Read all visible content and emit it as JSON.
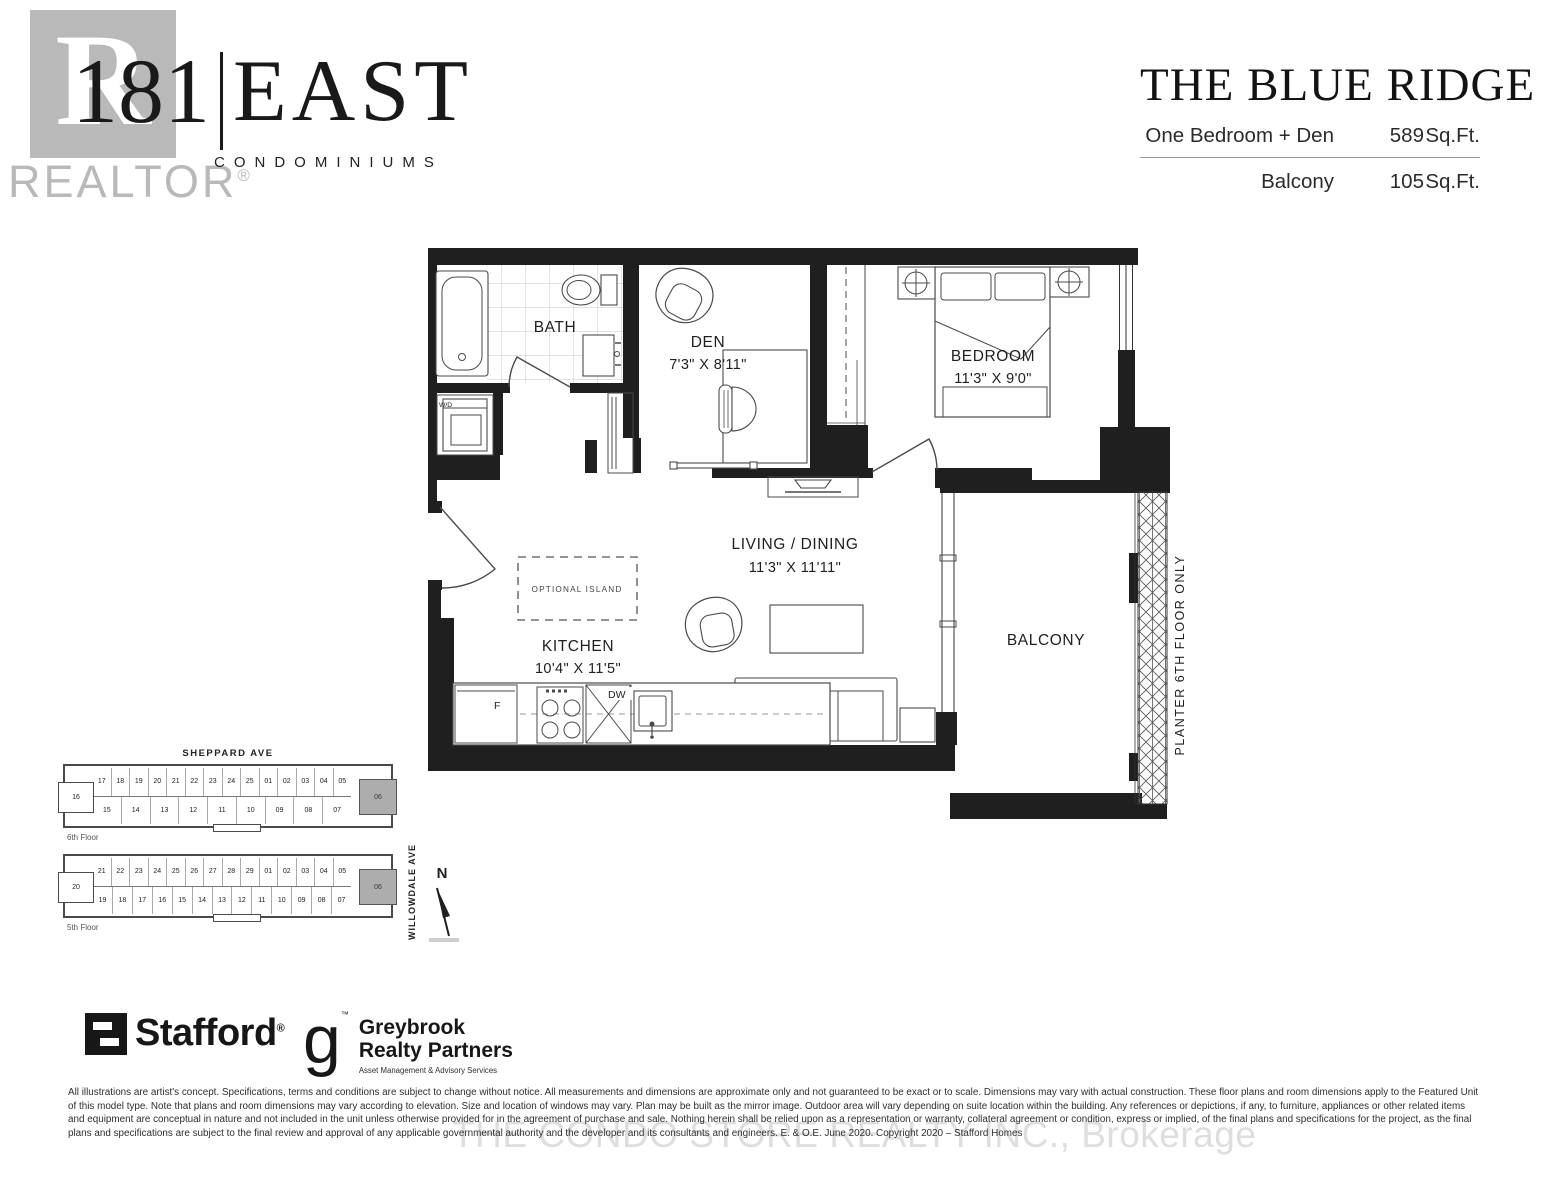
{
  "brand": {
    "realtor_logo": {
      "letter": "R",
      "label": "REALTOR",
      "reg": "®"
    },
    "logo": {
      "number": "181",
      "name": "EAST",
      "subtitle": "CONDOMINIUMS"
    }
  },
  "title_block": {
    "plan_name": "THE BLUE RIDGE",
    "rows": [
      {
        "label": "One Bedroom + Den",
        "value": "589",
        "unit": "Sq.Ft."
      },
      {
        "label": "Balcony",
        "value": "105",
        "unit": "Sq.Ft."
      }
    ]
  },
  "floorplan": {
    "bath": {
      "label": "BATH"
    },
    "wd": {
      "label": "W/D"
    },
    "den": {
      "label": "DEN",
      "dims": "7'3\" X 8'11\""
    },
    "bedroom": {
      "label": "BEDROOM",
      "dims": "11'3\" X 9'0\""
    },
    "living": {
      "label": "LIVING / DINING",
      "dims": "11'3\" X 11'11\""
    },
    "kitchen": {
      "label": "KITCHEN",
      "dims": "10'4\" X 11'5\""
    },
    "balcony": {
      "label": "BALCONY"
    },
    "island": {
      "label": "OPTIONAL ISLAND"
    },
    "fridge": {
      "label": "F"
    },
    "dishwasher": {
      "label": "DW"
    },
    "planter": {
      "label": "PLANTER 6TH FLOOR ONLY"
    }
  },
  "keyplans": {
    "street_top": "SHEPPARD AVE",
    "street_side": "WILLOWDALE AVE",
    "north": "N",
    "floors": [
      {
        "floor_label": "6th Floor",
        "top_row": [
          "17",
          "18",
          "19",
          "20",
          "21",
          "22",
          "23",
          "24",
          "25",
          "01",
          "02",
          "03",
          "04",
          "05"
        ],
        "left_unit": "16",
        "bottom_row": [
          "15",
          "14",
          "13",
          "12",
          "11",
          "10",
          "09",
          "08",
          "07"
        ],
        "highlight_unit": "06"
      },
      {
        "floor_label": "5th Floor",
        "top_row": [
          "21",
          "22",
          "23",
          "24",
          "25",
          "26",
          "27",
          "28",
          "29",
          "01",
          "02",
          "03",
          "04",
          "05"
        ],
        "left_unit": "20",
        "bottom_row": [
          "19",
          "18",
          "17",
          "16",
          "15",
          "14",
          "13",
          "12",
          "11",
          "10",
          "09",
          "08",
          "07"
        ],
        "highlight_unit": "06"
      }
    ]
  },
  "partners": {
    "stafford": {
      "name": "Stafford",
      "reg": "®"
    },
    "greybrook": {
      "initial": "g",
      "tm": "™",
      "line1": "Greybrook",
      "line2": "Realty Partners",
      "tagline": "Asset Management & Advisory Services"
    }
  },
  "legal": {
    "disclaimer": "All illustrations are artist's concept. Specifications, terms and conditions are subject to change without notice. All measurements and dimensions are approximate only and not guaranteed to be exact or to scale. Dimensions may vary with actual construction. These floor plans and room dimensions apply to the Featured Unit of this model type. Note that plans and room dimensions may vary according to elevation. Size and location of windows may vary. Plan may be built as the mirror image. Outdoor area will vary depending on suite location within the building. Any references or depictions, if any, to furniture, appliances or other related items and equipment are conceptual in nature and not included in the unit unless otherwise provided for in the agreement of purchase and sale. Nothing herein shall be relied upon as a representation or warranty, collateral agreement or condition, express or implied, of the final plans and specifications for the project, as the final plans and specifications are subject to the final review and approval of any applicable governmental authority and the developer and its consultants and engineers. E. & O.E. June 2020. Copyright 2020 – Stafford Homes",
    "watermark": "THE CONDO STORE REALTY INC., Brokerage"
  },
  "colors": {
    "wall": "#1f1f1f",
    "highlight_unit": "#adadad",
    "realtor_gray": "#b9b9b9",
    "watermark_gray": "#dedede"
  }
}
